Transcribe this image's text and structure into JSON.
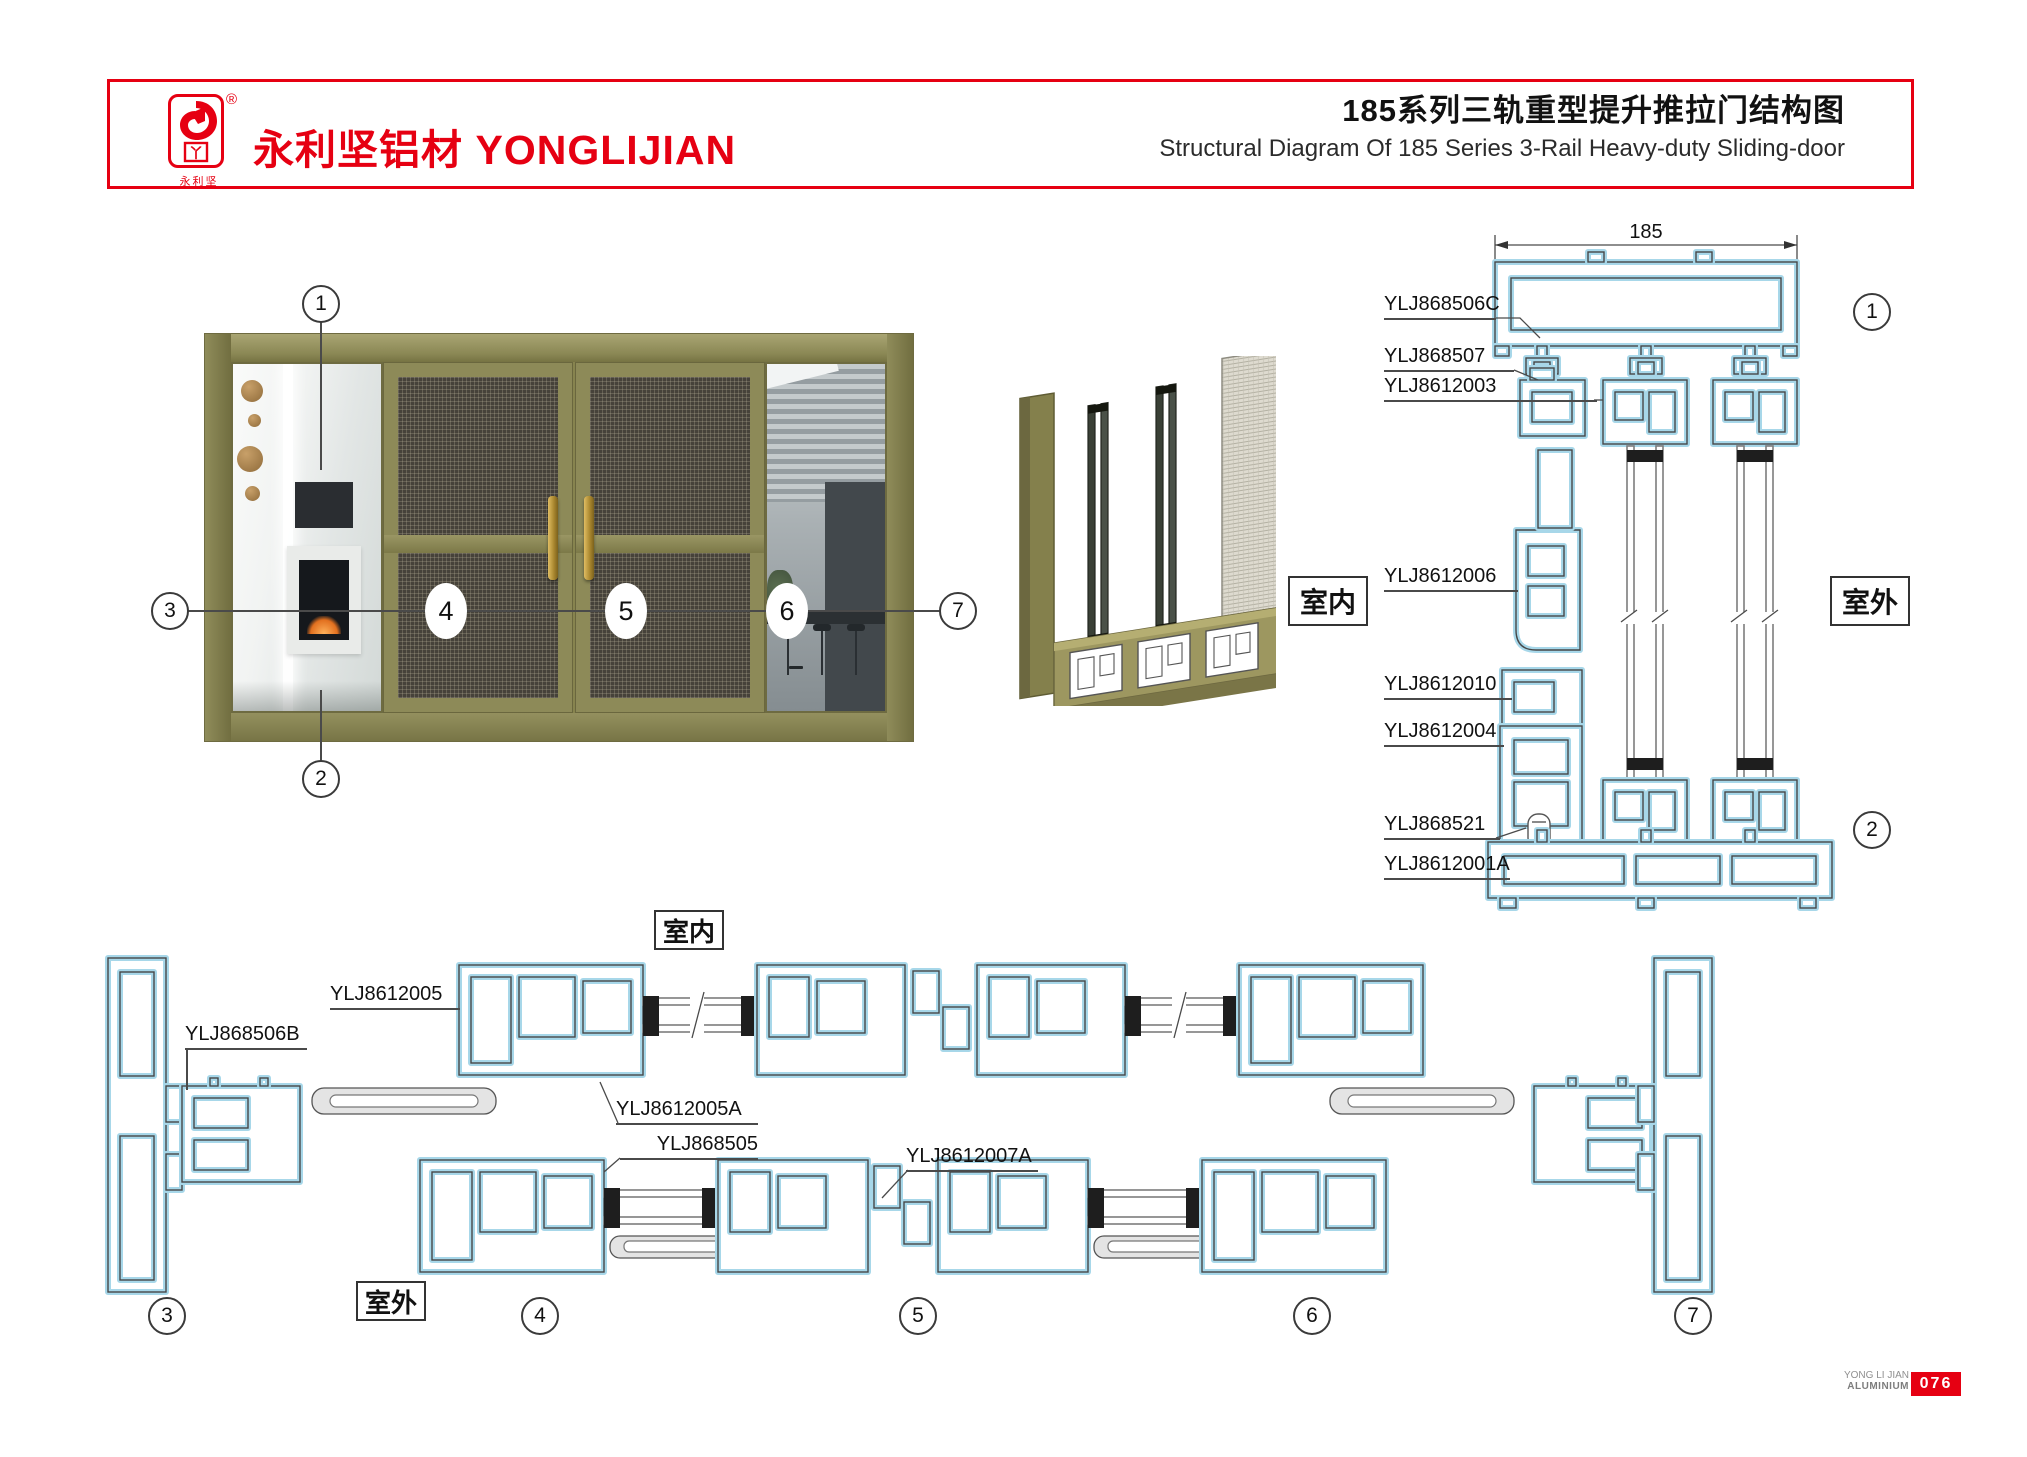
{
  "header": {
    "registered_mark": "®",
    "emblem_char": "丫",
    "emblem_caption": "永利坚",
    "brand_cn": "永利坚铝材",
    "brand_en": "YONGLIJIAN",
    "title_cn": "185系列三轨重型提升推拉门结构图",
    "title_en": "Structural Diagram Of 185 Series 3-Rail Heavy-duty Sliding-door"
  },
  "door_view": {
    "callouts": {
      "c1": "1",
      "c2": "2",
      "c3": "3",
      "c4": "4",
      "c5": "5",
      "c6": "6",
      "c7": "7"
    }
  },
  "vertical_section": {
    "dimension": "185",
    "labels": [
      "YLJ868506C",
      "YLJ868507",
      "YLJ8612003",
      "YLJ8612006",
      "YLJ8612010",
      "YLJ8612004",
      "YLJ868521",
      "YLJ8612001A"
    ],
    "indoor": "室内",
    "outdoor": "室外",
    "callout_top": "1",
    "callout_bottom": "2"
  },
  "horizontal_section": {
    "labels": [
      "YLJ8612005",
      "YLJ868506B",
      "YLJ8612005A",
      "YLJ868505",
      "YLJ8612007A"
    ],
    "indoor": "室内",
    "outdoor": "室外",
    "callouts": [
      "3",
      "4",
      "5",
      "6",
      "7"
    ]
  },
  "footer": {
    "brand_top": "YONG LI JIAN",
    "brand_bottom": "ALUMINIUM",
    "page_number": "076"
  },
  "colors": {
    "accent_red": "#e60012",
    "profile_cyan": "#a7d7e9",
    "line_dark": "#4a4a4a",
    "door_olive": "#87844f"
  }
}
